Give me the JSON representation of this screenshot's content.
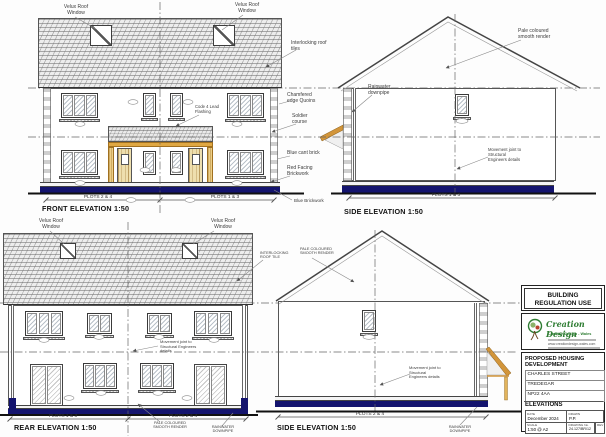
{
  "front": {
    "title": "FRONT ELEVATION  1:50",
    "velux": "Velux Roof Window",
    "interlocking": "Interlocking roof tiles",
    "chamfered": "Chamfered edge Quoins",
    "soldier": "Soldier course",
    "code4": "Code 4 Lead Flashing",
    "blue_cant": "Blue cant brick",
    "red_facing": "Red Facing Brickwork",
    "blue_brickwork": "Blue Brickwork",
    "plots_left": "PLOTS 2 & 4",
    "plots_right": "PLOTS 1 & 3"
  },
  "side_top": {
    "title": "SIDE ELEVATION  1:50",
    "render": "Pale coloured smooth render",
    "downpipe": "Rainwater downpipe",
    "movement": "Movement joint to Structural Engineers details",
    "plots": "PLOTS 1 & 3"
  },
  "rear": {
    "title": "REAR ELEVATION  1:50",
    "velux": "Velux Roof Window",
    "interlocking": "INTERLOCKING ROOF TILE",
    "movement": "Movement joint to Structural Engineers details",
    "render": "PALE COLOURED SMOOTH RENDER",
    "downpipe": "RAINWATER DOWNPIPE",
    "plots_left": "PLOTS 1 & 3",
    "plots_right": "PLOTS 2 & 4"
  },
  "side_bottom": {
    "title": "SIDE ELEVATION  1:50",
    "render": "PALE COLOURED SMOOTH RENDER",
    "movement": "Movement joint to Structural Engineers details",
    "downpipe": "RAINWATER DOWNPIPE",
    "plots": "PLOTS 2 & 4"
  },
  "title_block": {
    "use_line1": "BUILDING",
    "use_line2": "REGULATION USE",
    "logo_name": "Creation Design",
    "logo_sub": "Creation Design - Wales",
    "logo_web": "www.creationdesign-wales.com",
    "project_line1": "PROPOSED HOUSING",
    "project_line2": "DEVELOPMENT",
    "address1": "CHARLES STREET",
    "address2": "TREDEGAR",
    "address3": "NP22 4AA",
    "sheet_title": "ELEVATIONS",
    "date_label": "DATE",
    "date": "December 2024",
    "drawn_label": "DRAWN",
    "drawn": "P.P.",
    "scale_label": "SCALE",
    "scale": "1:50 @ A2",
    "number_label": "DRAWING No.",
    "number": "24.127/BR/12",
    "rev_label": "REV"
  },
  "colors": {
    "navy": "#14146e",
    "timber": "#dd9e3c",
    "logo_green": "#2f7d33",
    "roof": "#ededed"
  }
}
